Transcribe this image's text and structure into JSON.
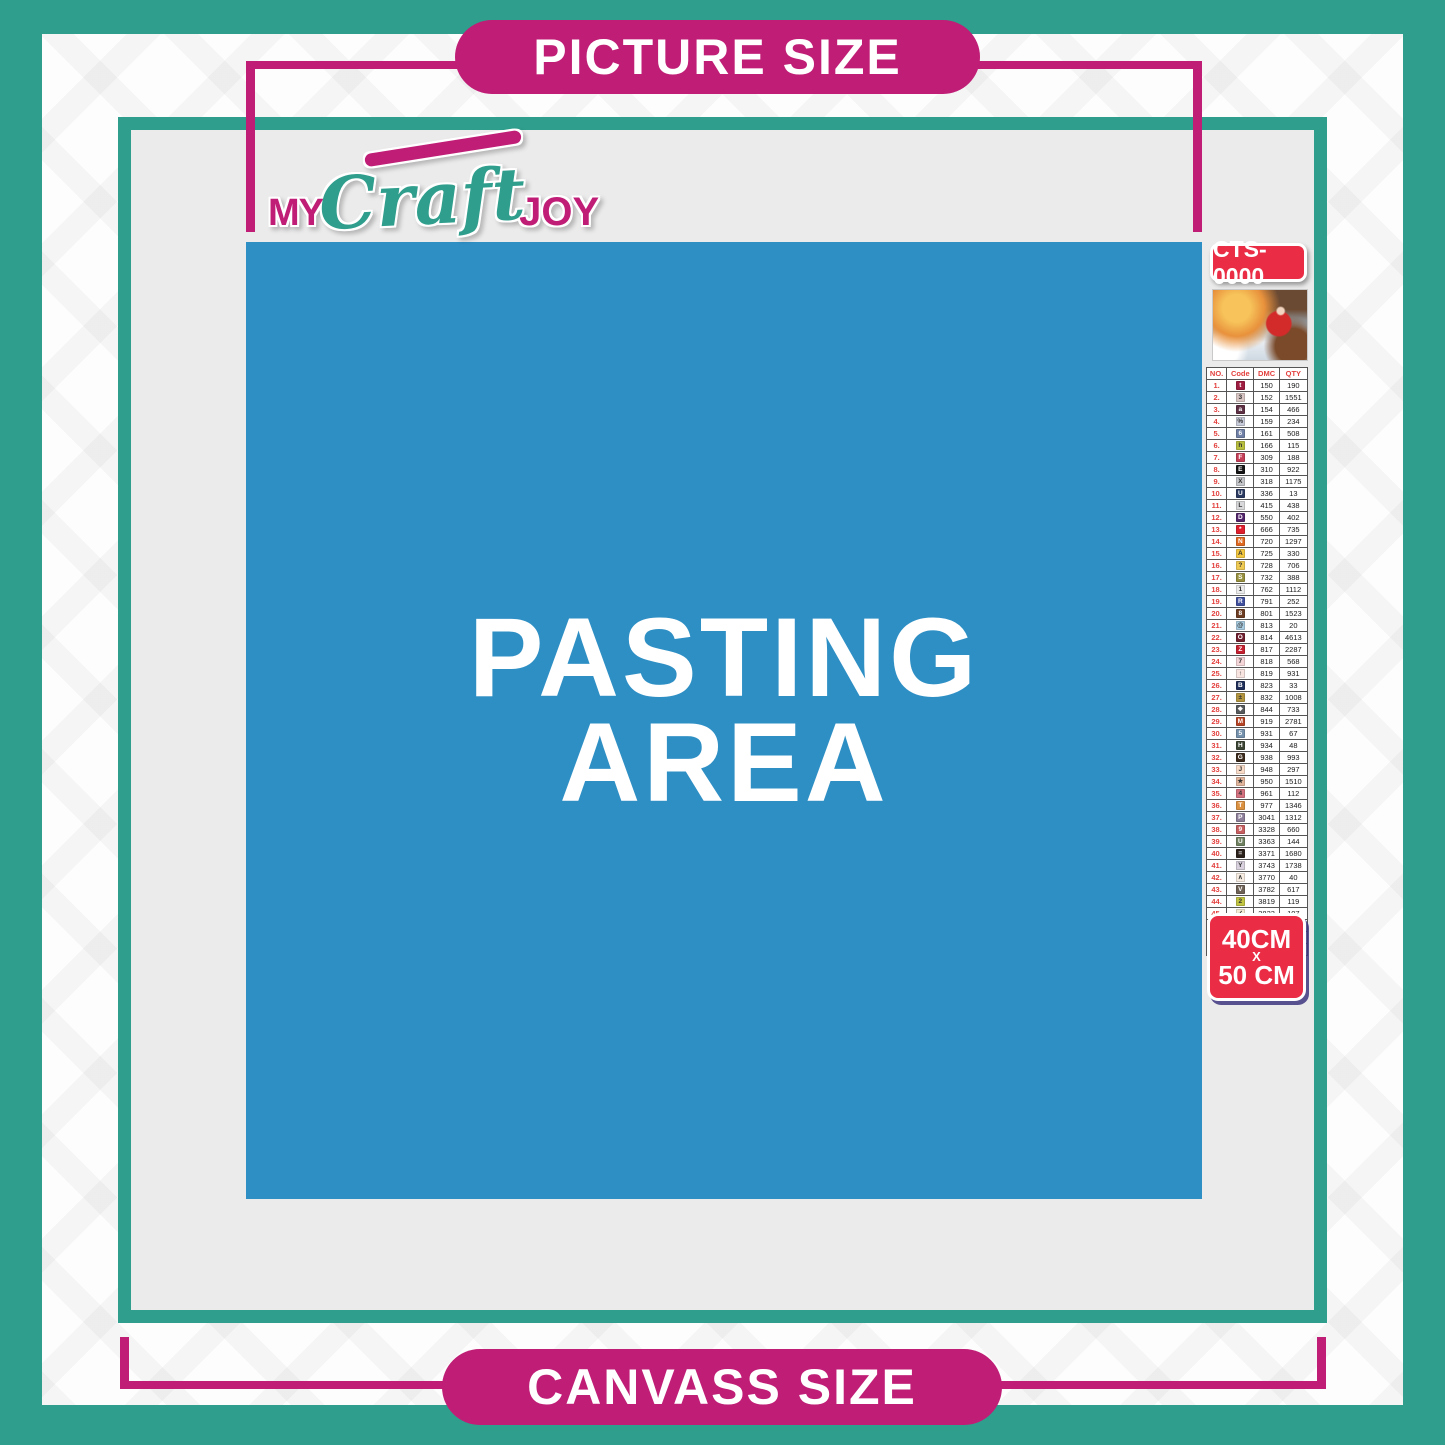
{
  "banners": {
    "top": "PICTURE SIZE",
    "bottom": "CANVASS SIZE"
  },
  "logo": {
    "part1": "MY",
    "part2": "Craft",
    "part3": "JOY"
  },
  "pasting_area": {
    "line1": "PASTING",
    "line2": "AREA"
  },
  "legend": {
    "code_badge": "CTS-0000",
    "size_badge": {
      "line1": "40CM",
      "line2": "X",
      "line3": "50 CM"
    },
    "table": {
      "headers": [
        "NO.",
        "Code",
        "DMC",
        "QTY"
      ],
      "rows": [
        {
          "no": "1.",
          "sym": "t",
          "bg": "#a01d42",
          "fg": "#ffffff",
          "dmc": "150",
          "qty": "190"
        },
        {
          "no": "2.",
          "sym": "3",
          "bg": "#d9c6c4",
          "fg": "#333333",
          "dmc": "152",
          "qty": "1551"
        },
        {
          "no": "3.",
          "sym": "a",
          "bg": "#5e3044",
          "fg": "#ffffff",
          "dmc": "154",
          "qty": "466"
        },
        {
          "no": "4.",
          "sym": "%",
          "bg": "#c8cbd9",
          "fg": "#333333",
          "dmc": "159",
          "qty": "234"
        },
        {
          "no": "5.",
          "sym": "6",
          "bg": "#6f7fa5",
          "fg": "#ffffff",
          "dmc": "161",
          "qty": "508"
        },
        {
          "no": "6.",
          "sym": "h",
          "bg": "#b8bf3e",
          "fg": "#333333",
          "dmc": "166",
          "qty": "115"
        },
        {
          "no": "7.",
          "sym": "F",
          "bg": "#c43e57",
          "fg": "#ffffff",
          "dmc": "309",
          "qty": "188"
        },
        {
          "no": "8.",
          "sym": "E",
          "bg": "#141414",
          "fg": "#ffffff",
          "dmc": "310",
          "qty": "922"
        },
        {
          "no": "9.",
          "sym": "X",
          "bg": "#c4c5c8",
          "fg": "#333333",
          "dmc": "318",
          "qty": "1175"
        },
        {
          "no": "10.",
          "sym": "U",
          "bg": "#2a3a60",
          "fg": "#ffffff",
          "dmc": "336",
          "qty": "13"
        },
        {
          "no": "11.",
          "sym": "L",
          "bg": "#d8d8da",
          "fg": "#333333",
          "dmc": "415",
          "qty": "438"
        },
        {
          "no": "12.",
          "sym": "D",
          "bg": "#53256b",
          "fg": "#ffffff",
          "dmc": "550",
          "qty": "402"
        },
        {
          "no": "13.",
          "sym": "*",
          "bg": "#df1f2d",
          "fg": "#ffffff",
          "dmc": "666",
          "qty": "735"
        },
        {
          "no": "14.",
          "sym": "N",
          "bg": "#e06a22",
          "fg": "#ffffff",
          "dmc": "720",
          "qty": "1297"
        },
        {
          "no": "15.",
          "sym": "A",
          "bg": "#f2c63e",
          "fg": "#333333",
          "dmc": "725",
          "qty": "330"
        },
        {
          "no": "16.",
          "sym": "?",
          "bg": "#efca52",
          "fg": "#333333",
          "dmc": "728",
          "qty": "706"
        },
        {
          "no": "17.",
          "sym": "S",
          "bg": "#97903f",
          "fg": "#ffffff",
          "dmc": "732",
          "qty": "388"
        },
        {
          "no": "18.",
          "sym": "1",
          "bg": "#ecebeb",
          "fg": "#333333",
          "dmc": "762",
          "qty": "1112"
        },
        {
          "no": "19.",
          "sym": "R",
          "bg": "#41519e",
          "fg": "#ffffff",
          "dmc": "791",
          "qty": "252"
        },
        {
          "no": "20.",
          "sym": "8",
          "bg": "#6d3d23",
          "fg": "#ffffff",
          "dmc": "801",
          "qty": "1523"
        },
        {
          "no": "21.",
          "sym": "@",
          "bg": "#a9cde2",
          "fg": "#333333",
          "dmc": "813",
          "qty": "20"
        },
        {
          "no": "22.",
          "sym": "O",
          "bg": "#701f2f",
          "fg": "#ffffff",
          "dmc": "814",
          "qty": "4613"
        },
        {
          "no": "23.",
          "sym": "Z",
          "bg": "#c5202f",
          "fg": "#ffffff",
          "dmc": "817",
          "qty": "2287"
        },
        {
          "no": "24.",
          "sym": "7",
          "bg": "#f5d6d8",
          "fg": "#333333",
          "dmc": "818",
          "qty": "568"
        },
        {
          "no": "25.",
          "sym": "↑",
          "bg": "#f8e4e1",
          "fg": "#333333",
          "dmc": "819",
          "qty": "931"
        },
        {
          "no": "26.",
          "sym": "B",
          "bg": "#20305a",
          "fg": "#ffffff",
          "dmc": "823",
          "qty": "33"
        },
        {
          "no": "27.",
          "sym": "±",
          "bg": "#b2943f",
          "fg": "#333333",
          "dmc": "832",
          "qty": "1008"
        },
        {
          "no": "28.",
          "sym": "❖",
          "bg": "#56595b",
          "fg": "#ffffff",
          "dmc": "844",
          "qty": "733"
        },
        {
          "no": "29.",
          "sym": "M",
          "bg": "#b54526",
          "fg": "#ffffff",
          "dmc": "919",
          "qty": "2781"
        },
        {
          "no": "30.",
          "sym": "5",
          "bg": "#7591ac",
          "fg": "#ffffff",
          "dmc": "931",
          "qty": "67"
        },
        {
          "no": "31.",
          "sym": "H",
          "bg": "#3c4434",
          "fg": "#ffffff",
          "dmc": "934",
          "qty": "48"
        },
        {
          "no": "32.",
          "sym": "G",
          "bg": "#3d2c1e",
          "fg": "#ffffff",
          "dmc": "938",
          "qty": "993"
        },
        {
          "no": "33.",
          "sym": "J",
          "bg": "#f9dcc8",
          "fg": "#333333",
          "dmc": "948",
          "qty": "297"
        },
        {
          "no": "34.",
          "sym": "★",
          "bg": "#e2b69c",
          "fg": "#333333",
          "dmc": "950",
          "qty": "1510"
        },
        {
          "no": "35.",
          "sym": "4",
          "bg": "#d4717f",
          "fg": "#333333",
          "dmc": "961",
          "qty": "112"
        },
        {
          "no": "36.",
          "sym": "T",
          "bg": "#db9140",
          "fg": "#ffffff",
          "dmc": "977",
          "qty": "1346"
        },
        {
          "no": "37.",
          "sym": "P",
          "bg": "#8d7f99",
          "fg": "#ffffff",
          "dmc": "3041",
          "qty": "1312"
        },
        {
          "no": "38.",
          "sym": "9",
          "bg": "#c75f60",
          "fg": "#ffffff",
          "dmc": "3328",
          "qty": "660"
        },
        {
          "no": "39.",
          "sym": "U",
          "bg": "#6f8161",
          "fg": "#ffffff",
          "dmc": "3363",
          "qty": "144"
        },
        {
          "no": "40.",
          "sym": "=",
          "bg": "#2c221c",
          "fg": "#ffffff",
          "dmc": "3371",
          "qty": "1680"
        },
        {
          "no": "41.",
          "sym": "Y",
          "bg": "#d9d2de",
          "fg": "#333333",
          "dmc": "3743",
          "qty": "1738"
        },
        {
          "no": "42.",
          "sym": "∧",
          "bg": "#f6ece1",
          "fg": "#333333",
          "dmc": "3770",
          "qty": "40"
        },
        {
          "no": "43.",
          "sym": "V",
          "bg": "#6e6257",
          "fg": "#ffffff",
          "dmc": "3782",
          "qty": "617"
        },
        {
          "no": "44.",
          "sym": "2",
          "bg": "#c1c542",
          "fg": "#333333",
          "dmc": "3819",
          "qty": "119"
        },
        {
          "no": "45.",
          "sym": "✓",
          "bg": "#f4ecd4",
          "fg": "#333333",
          "dmc": "3823",
          "qty": "107"
        },
        {
          "no": "46.",
          "sym": "C",
          "bg": "#d07d3b",
          "fg": "#ffffff",
          "dmc": "3853",
          "qty": "1332"
        },
        {
          "no": "47.",
          "sym": "K",
          "bg": "#81483f",
          "fg": "#ffffff",
          "dmc": "3858",
          "qty": "2311"
        },
        {
          "no": "48.",
          "sym": "A",
          "bg": "#8d715e",
          "fg": "#ffffff",
          "dmc": "3863",
          "qty": "1820"
        }
      ]
    }
  },
  "colors": {
    "teal": "#2f9e8c",
    "magenta": "#c01d76",
    "blue": "#2e8fc5",
    "panel_gray": "#ebebeb",
    "badge_red": "#ea2c45",
    "table_header_red": "#e2413e",
    "text_white": "#ffffff"
  }
}
